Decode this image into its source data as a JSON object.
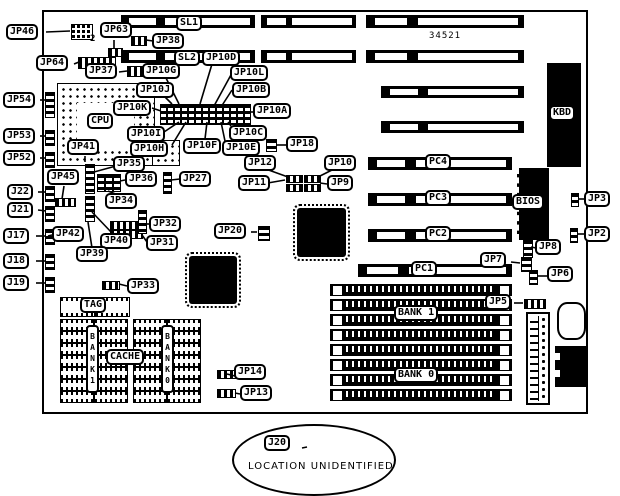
{
  "board": {
    "number": "34521"
  },
  "slots": {
    "sl1": "SL1",
    "sl2": "SL2",
    "pc1": "PC1",
    "pc2": "PC2",
    "pc3": "PC3",
    "pc4": "PC4"
  },
  "chips": {
    "cpu": "CPU",
    "bios": "BIOS",
    "kbd": "KBD",
    "tag": "TAG",
    "cache": "CACHE"
  },
  "memory": {
    "simm_bank1": "BANK 1",
    "simm_bank0": "BANK 0",
    "cache_bank1": "BANK1",
    "cache_bank0": "BANK0"
  },
  "labels": {
    "jp46": "JP46",
    "jp46_pins": "2",
    "jp63": "JP63",
    "jp38": "JP38",
    "jp64": "JP64",
    "jp37": "JP37",
    "jp54": "JP54",
    "jp53": "JP53",
    "jp52": "JP52",
    "jp45": "JP45",
    "j22": "J22",
    "j21": "J21",
    "j17": "J17",
    "j18": "J18",
    "j19": "J19",
    "jp42": "JP42",
    "jp39": "JP39",
    "jp40": "JP40",
    "jp32": "JP32",
    "jp31": "JP31",
    "jp33": "JP33",
    "jp34": "JP34",
    "jp35": "JP35",
    "jp36": "JP36",
    "jp27": "JP27",
    "jp41": "JP41",
    "jp10a": "JP10A",
    "jp10b": "JP10B",
    "jp10c": "JP10C",
    "jp10d": "JP10D",
    "jp10e": "JP10E",
    "jp10f": "JP10F",
    "jp10g": "JP10G",
    "jp10h": "JP10H",
    "jp10i": "JP10I",
    "jp10j": "JP10J",
    "jp10k": "JP10K",
    "jp10l": "JP10L",
    "jp18": "JP18",
    "jp12": "JP12",
    "jp11": "JP11",
    "jp10": "JP10",
    "jp9": "JP9",
    "jp20": "JP20",
    "jp14": "JP14",
    "jp13": "JP13",
    "jp2": "JP2",
    "jp3": "JP3",
    "jp5": "JP5",
    "jp6": "JP6",
    "jp7": "JP7",
    "jp8": "JP8"
  },
  "note": {
    "label": "J20",
    "text": "LOCATION UNIDENTIFIED"
  }
}
